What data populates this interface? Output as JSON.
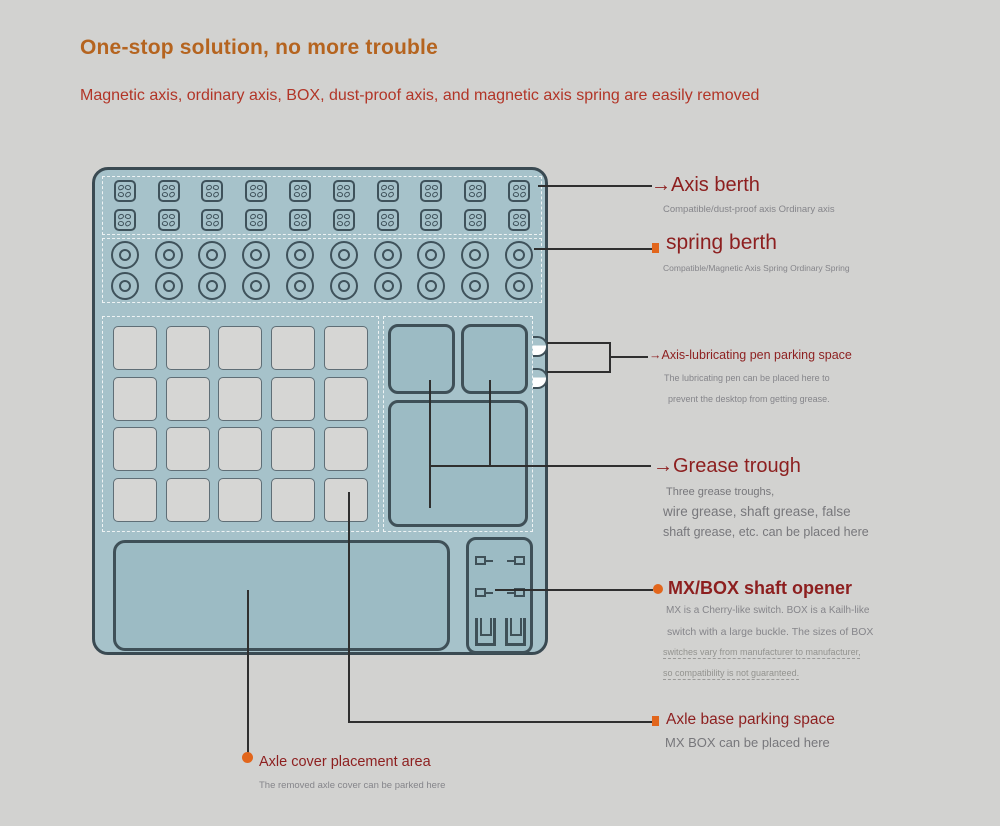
{
  "header": {
    "title": "One-stop solution, no more trouble",
    "subtitle": "Magnetic axis, ordinary axis, BOX, dust-proof axis, and magnetic axis spring are easily removed"
  },
  "device": {
    "axis_berth_grid": {
      "rows": 2,
      "cols": 10
    },
    "spring_berth_grid": {
      "rows": 2,
      "cols": 10
    },
    "axle_base_grid": {
      "rows": 4,
      "cols": 5
    },
    "grease_trough_count": 3,
    "pen_clip_count": 2
  },
  "annotations": {
    "axis_berth": {
      "arrow": "→",
      "label": "Axis berth",
      "sub": "Compatible/dust-proof axis Ordinary axis"
    },
    "spring_berth": {
      "label": "spring berth",
      "sub": "Compatible/Magnetic Axis Spring Ordinary Spring"
    },
    "pen_parking": {
      "arrow": "→",
      "label": "Axis-lubricating pen parking space",
      "sub1": "The lubricating pen can be placed here to",
      "sub2": "prevent the desktop from getting grease."
    },
    "grease_trough": {
      "arrow": "→",
      "label": "Grease trough",
      "sub1": "Three grease troughs,",
      "sub2": "wire grease, shaft grease, false",
      "sub3": "shaft grease, etc. can be placed here"
    },
    "shaft_opener": {
      "label": "MX/BOX shaft opener",
      "sub1": "MX is a Cherry-like switch. BOX is a Kailh-like",
      "sub2": "switch with a large buckle. The sizes of BOX",
      "sub3": "switches vary from manufacturer to manufacturer,",
      "sub4": "so compatibility is not guaranteed."
    },
    "axle_base": {
      "label": "Axle base parking space",
      "sub": "MX BOX can be placed here"
    },
    "axle_cover": {
      "label": "Axle cover placement area",
      "sub": "The removed axle cover can be parked here"
    }
  },
  "colors": {
    "background": "#d2d2d0",
    "title": "#b5641f",
    "subtitle": "#b23527",
    "label_red": "#8d1f1f",
    "accent_orange": "#e2661c",
    "sub_text_gray": "#85858a",
    "line": "#2f2f2f",
    "device_fill": "#a6c2ca",
    "device_border": "#3a4a52",
    "slot_fill": "#d6d6d4"
  }
}
